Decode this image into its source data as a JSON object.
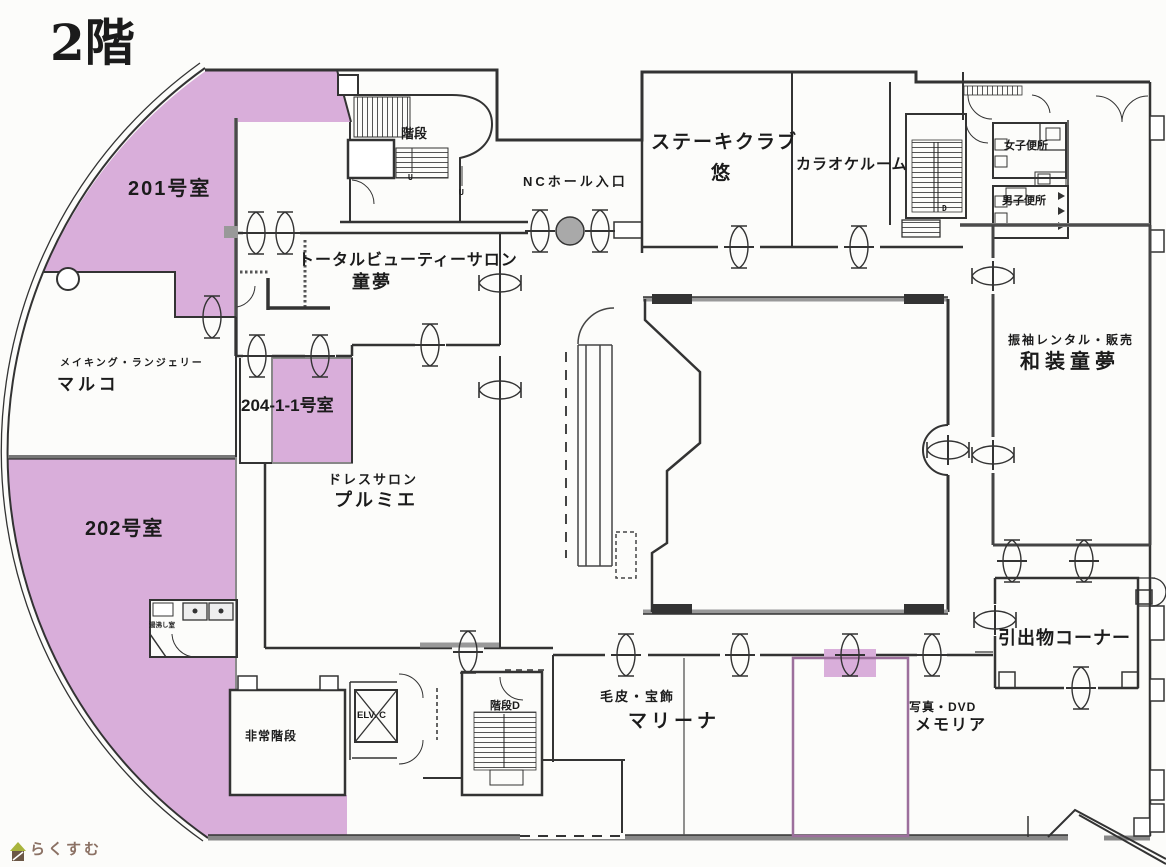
{
  "page": {
    "type": "building-floor-plan-scan",
    "floor_title": "2階",
    "background": "#fcfcfa"
  },
  "colors": {
    "highlight_pink": "#d9aeda",
    "wall_dark": "#333333",
    "wall_gray": "#8a8a8a",
    "logo_brown": "#8b7164",
    "logo_roof_green": "#a8b43c",
    "logo_house_brown": "#6b5746"
  },
  "labels": {
    "floor_title": "2階",
    "room201": "201号室",
    "room202": "202号室",
    "room204": "204-1-1号室",
    "stairs_nw": "階段",
    "nc_hall_entrance": "NCホール入口",
    "steak_line1": "ステーキクラブ",
    "steak_line2": "悠",
    "karaoke": "カラオケルーム",
    "womens_toilet": "女子便所",
    "mens_toilet": "男子便所",
    "beauty_line1": "トータルビューティーサロン",
    "beauty_line2": "童夢",
    "furisode_line1": "振袖レンタル・販売",
    "furisode_line2": "和装童夢",
    "marco_line1": "メイキング・ランジェリー",
    "marco_line2": "マルコ",
    "dress_line1": "ドレスサロン",
    "dress_line2": "プルミエ",
    "gift_corner": "引出物コーナー",
    "fur_line1": "毛皮・宝飾",
    "fur_line2": "マリーナ",
    "photo_line1": "写真・DVD",
    "photo_line2": "メモリア",
    "emergency_stairs": "非常階段",
    "elevator": "ELV. C",
    "stairs_d": "階段D",
    "hot_water_room": "湯沸し室",
    "up_mark": "U",
    "down_mark": "D",
    "logo_text": "らくすむ"
  }
}
